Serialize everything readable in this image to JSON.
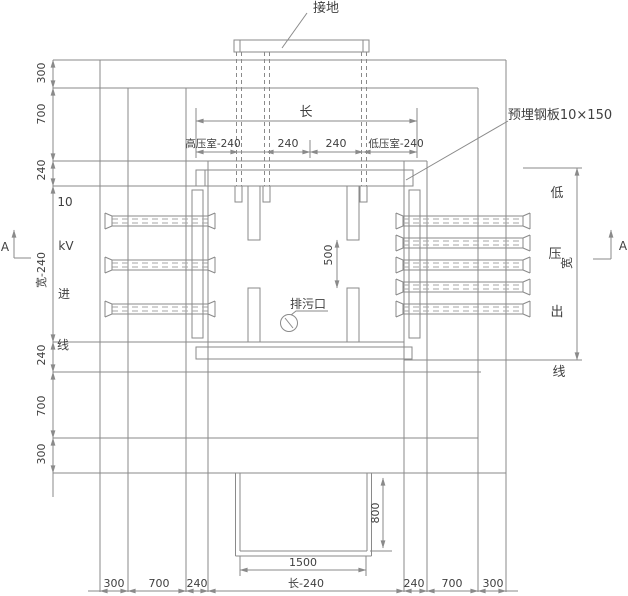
{
  "colors": {
    "line": "#8a8a8a",
    "dashed": "#a6a6a6",
    "text": "#3f3f3f",
    "background": "#ffffff"
  },
  "annotations": {
    "grounding": "接地",
    "embedded_plate": "预埋钢板10×150",
    "drain_outlet": "排污口"
  },
  "hv_incoming": {
    "l1": "10",
    "l2": "kV",
    "l3": "进",
    "l4": "线"
  },
  "lv_outgoing": {
    "l1": "低",
    "l2": "压",
    "l3": "出",
    "l4": "线"
  },
  "section": {
    "left": "A",
    "right": "A"
  },
  "dims": {
    "top_length": "长",
    "room_row": [
      "高压室-240",
      "240",
      "240",
      "低压室-240"
    ],
    "left_col": [
      "300",
      "700",
      "240",
      "宽-240",
      "240",
      "700",
      "300"
    ],
    "bottom_row": [
      "300",
      "700",
      "240",
      "长-240",
      "240",
      "700",
      "300"
    ],
    "rail_gap": "500",
    "right_width": "宽",
    "trench_width": "1500",
    "trench_depth": "800"
  }
}
